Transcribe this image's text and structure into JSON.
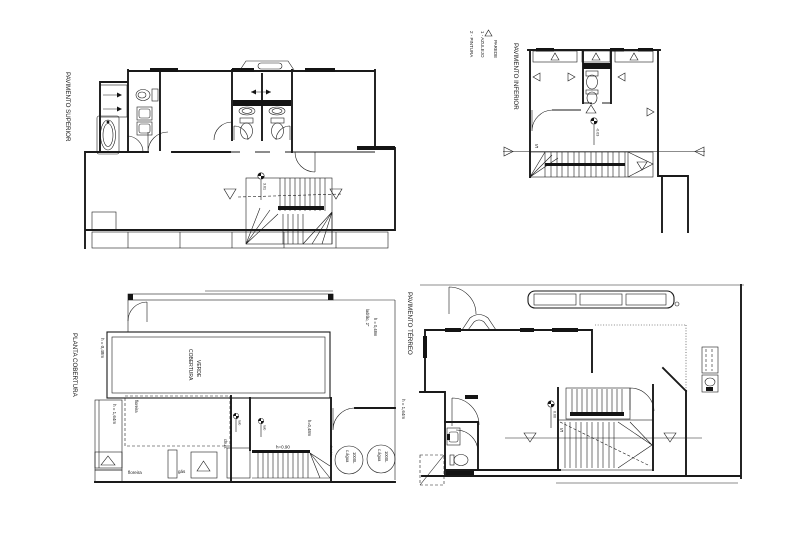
{
  "colors": {
    "ink": "#1a1a1a",
    "paper": "#ffffff"
  },
  "plans": {
    "superior": {
      "title": "PAVIMENTO SUPERIOR",
      "level": "3.01"
    },
    "inferior": {
      "title": "PAVIMENTO INFERIOR",
      "stair": "S",
      "level": "-0.03",
      "legend": {
        "parede": "PAREDE",
        "azulejo": "1 - AZULEJO",
        "pintura": "2 - PINTURA"
      }
    },
    "cobertura": {
      "title": "PLANTA COBERTURA",
      "green1": "COBERTURA",
      "green2": "VERDE",
      "h_left": "h = 0,48m",
      "h_planter": "h = 1,64m",
      "h_right": "h = 1,64m",
      "ladrao1": "ladrão, 2\"",
      "ladrao2": "h = 0,48m",
      "floreira_side": "floreira",
      "floreira_bottom": "floreira",
      "gas": "gás",
      "churrasqueira": "churr.",
      "divisoria": "divisória",
      "h_mid": "h=0,48m",
      "h_stair": "h=0.90",
      "ralo": "ralo",
      "tank_line1": "c.água",
      "tank_line2": "1000L"
    },
    "terreo": {
      "title": "PAVIMENTO TÉRREO",
      "stair": "S",
      "level": "0.00"
    }
  }
}
